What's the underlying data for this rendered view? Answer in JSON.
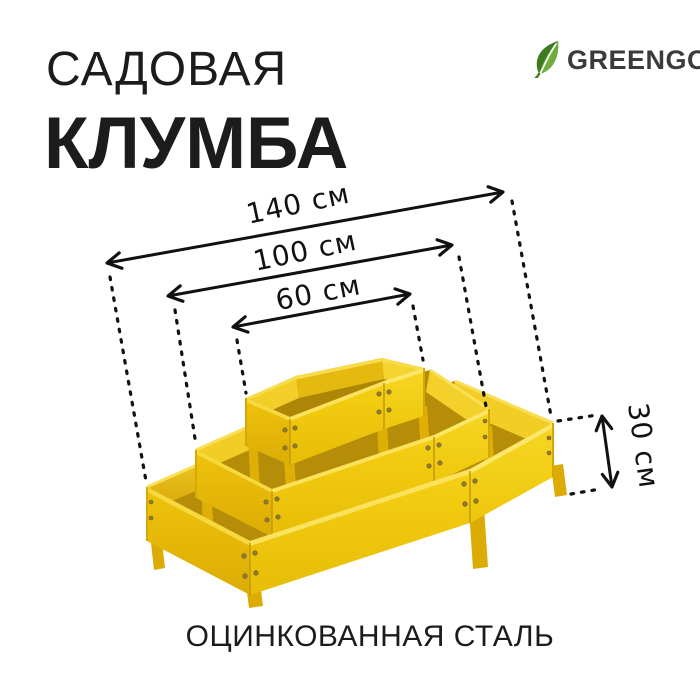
{
  "title": {
    "line1": "САДОВАЯ",
    "line2": "КЛУМБА"
  },
  "brand": {
    "name": "GREENGO"
  },
  "dimensions": {
    "bottom_tier": "140 см",
    "middle_tier": "100 см",
    "top_tier": "60 см",
    "height": "30 см"
  },
  "caption": "ОЦИНКОВАННАЯ СТАЛЬ",
  "product": {
    "tiers": 3,
    "shape": "hexagonal raised garden bed"
  },
  "colors": {
    "product_yellow": "#EFC70B",
    "brand_green": "#3E7B20",
    "brand_green_light": "#6FAC3E",
    "text_dark": "#1C1C1C"
  }
}
